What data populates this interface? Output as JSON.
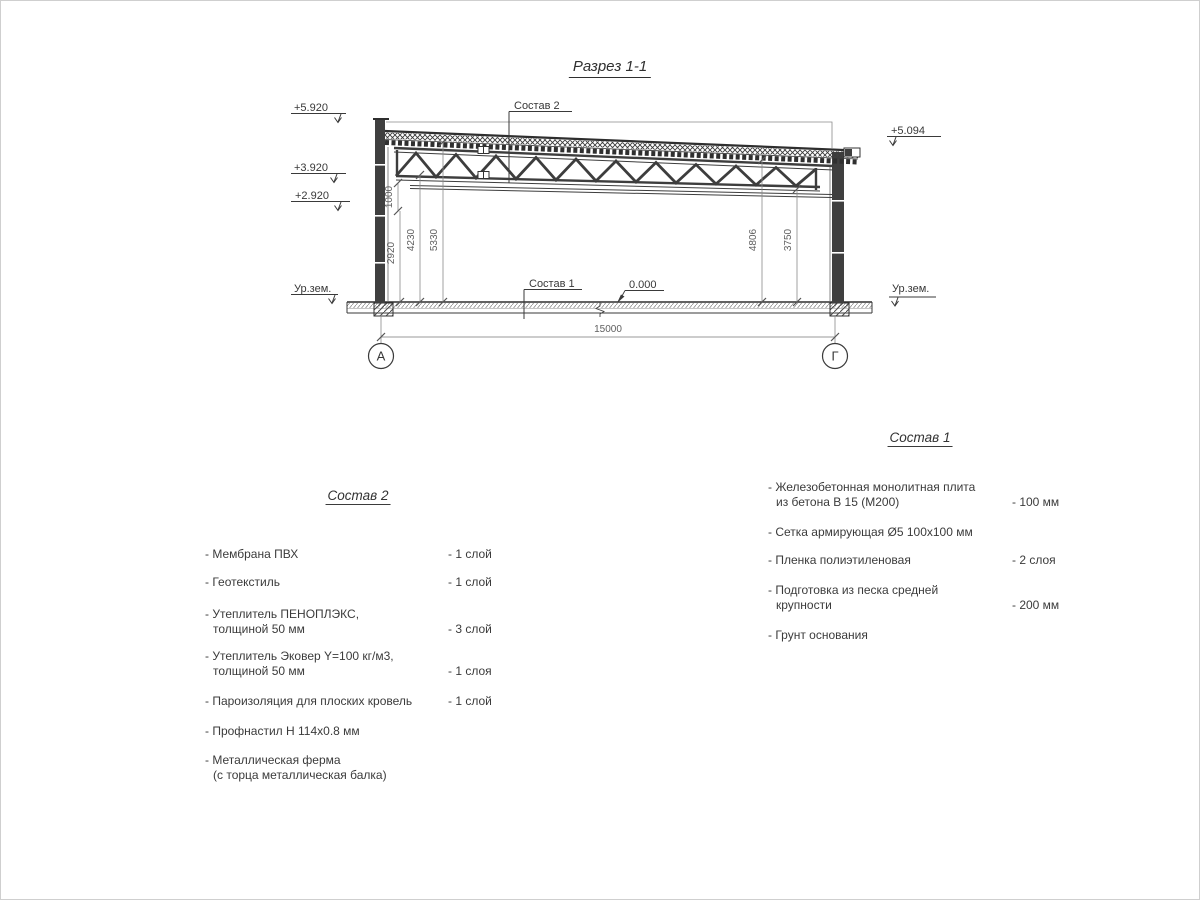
{
  "title": "Разрез 1-1",
  "drawing": {
    "labels": {
      "sostav2_callout": "Состав 2",
      "sostav1_callout": "Состав 1",
      "zero_level": "0.000",
      "ground_left": "Ур.зем.",
      "ground_right": "Ур.зем."
    },
    "elevations": {
      "left_top": "+5.920",
      "left_mid": "+3.920",
      "left_low": "+2.920",
      "right": "+5.094"
    },
    "dims": {
      "h1000": "1000",
      "h2920": "2920",
      "h4230": "4230",
      "h5330": "5330",
      "h4806": "4806",
      "h3750": "3750",
      "span": "15000"
    },
    "axes": {
      "left": "А",
      "right": "Г"
    }
  },
  "lists": {
    "sostav2": {
      "header": "Состав 2",
      "items": [
        {
          "line1": "- Мембрана ПВХ",
          "value": "- 1 слой"
        },
        {
          "line1": "- Геотекстиль",
          "value": "- 1 слой"
        },
        {
          "line1": "- Утеплитель ПЕНОПЛЭКС,",
          "line2": "толщиной 50 мм",
          "value": "- 3 слой"
        },
        {
          "line1": "- Утеплитель Эковер Y=100 кг/м3,",
          "line2": "толщиной 50 мм",
          "value": "- 1 слоя"
        },
        {
          "line1": "- Пароизоляция для плоских кровель",
          "value": "- 1 слой"
        },
        {
          "line1": "- Профнастил Н 114x0.8 мм"
        },
        {
          "line1": "- Металлическая ферма",
          "line2": "(с торца металлическая балка)"
        }
      ]
    },
    "sostav1": {
      "header": "Состав 1",
      "items": [
        {
          "line1": "- Железобетонная монолитная плита",
          "line2": "из бетона В 15 (М200)",
          "value": "- 100 мм"
        },
        {
          "line1": "- Сетка армирующая Ø5 100x100 мм"
        },
        {
          "line1": "- Пленка полиэтиленовая",
          "value": "- 2 слоя"
        },
        {
          "line1": "- Подготовка из песка средней",
          "line2": "крупности",
          "value": "- 200 мм"
        },
        {
          "line1": "- Грунт основания"
        }
      ]
    }
  }
}
